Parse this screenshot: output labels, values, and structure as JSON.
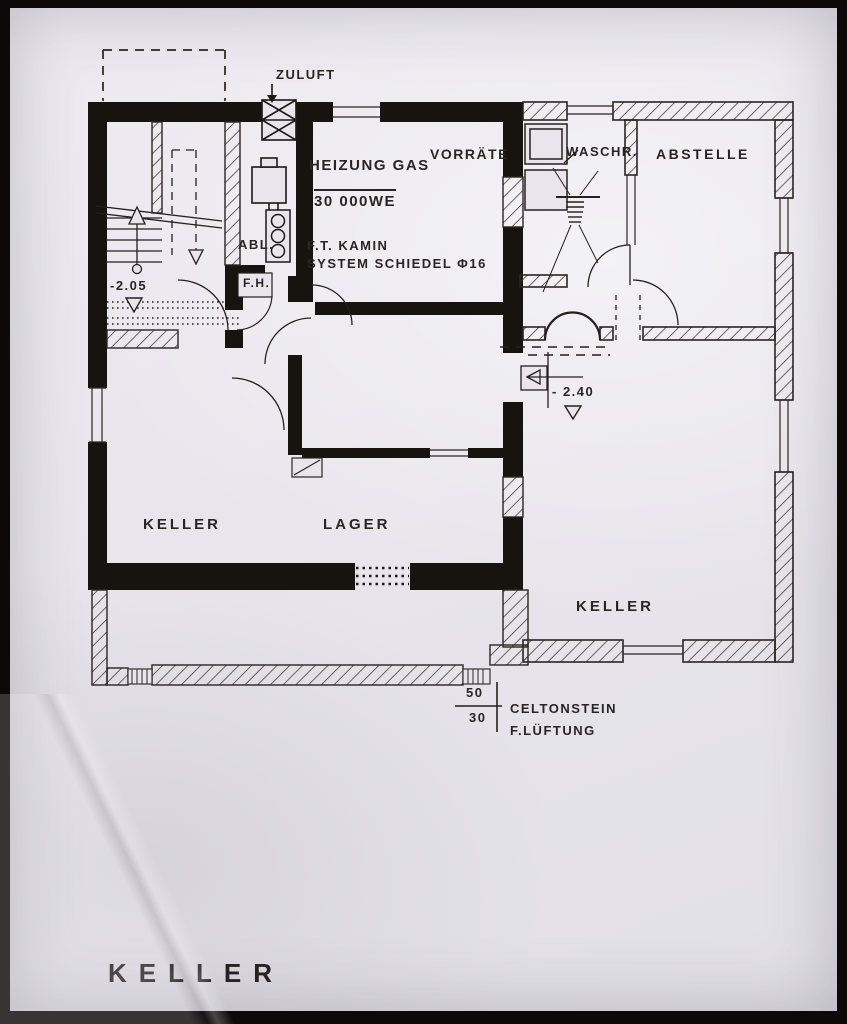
{
  "drawing": {
    "title": "KELLER",
    "colors": {
      "ink": "#231f1b",
      "paper": "#e8e6ec"
    },
    "labels": {
      "zuluft": "ZULUFT",
      "heizung_line1": "HEIZUNG GAS",
      "heizung_line2": "30 000WE",
      "vorraete": "VORRÄTE",
      "waschr": "WASCHR.",
      "abstelle": "ABSTELLE",
      "kamin_line1": "F.T. KAMIN",
      "kamin_line2": "SYSTEM SCHIEDEL Φ16",
      "abl": "ABL.",
      "fh": "F.H.",
      "level_stair": "-2.05",
      "level_keller": "- 2.40",
      "keller_left": "KELLER",
      "lager": "LAGER",
      "keller_right": "KELLER",
      "vent_num": "50",
      "vent_den": "30",
      "vent_note1": "CELTONSTEIN",
      "vent_note2": "F.LÜFTUNG"
    },
    "rooms": [
      {
        "name": "HEIZUNG GAS / VORRÄTE"
      },
      {
        "name": "WASCHR."
      },
      {
        "name": "ABSTELLE"
      },
      {
        "name": "KELLER (links)"
      },
      {
        "name": "LAGER"
      },
      {
        "name": "KELLER (rechts)"
      }
    ]
  }
}
